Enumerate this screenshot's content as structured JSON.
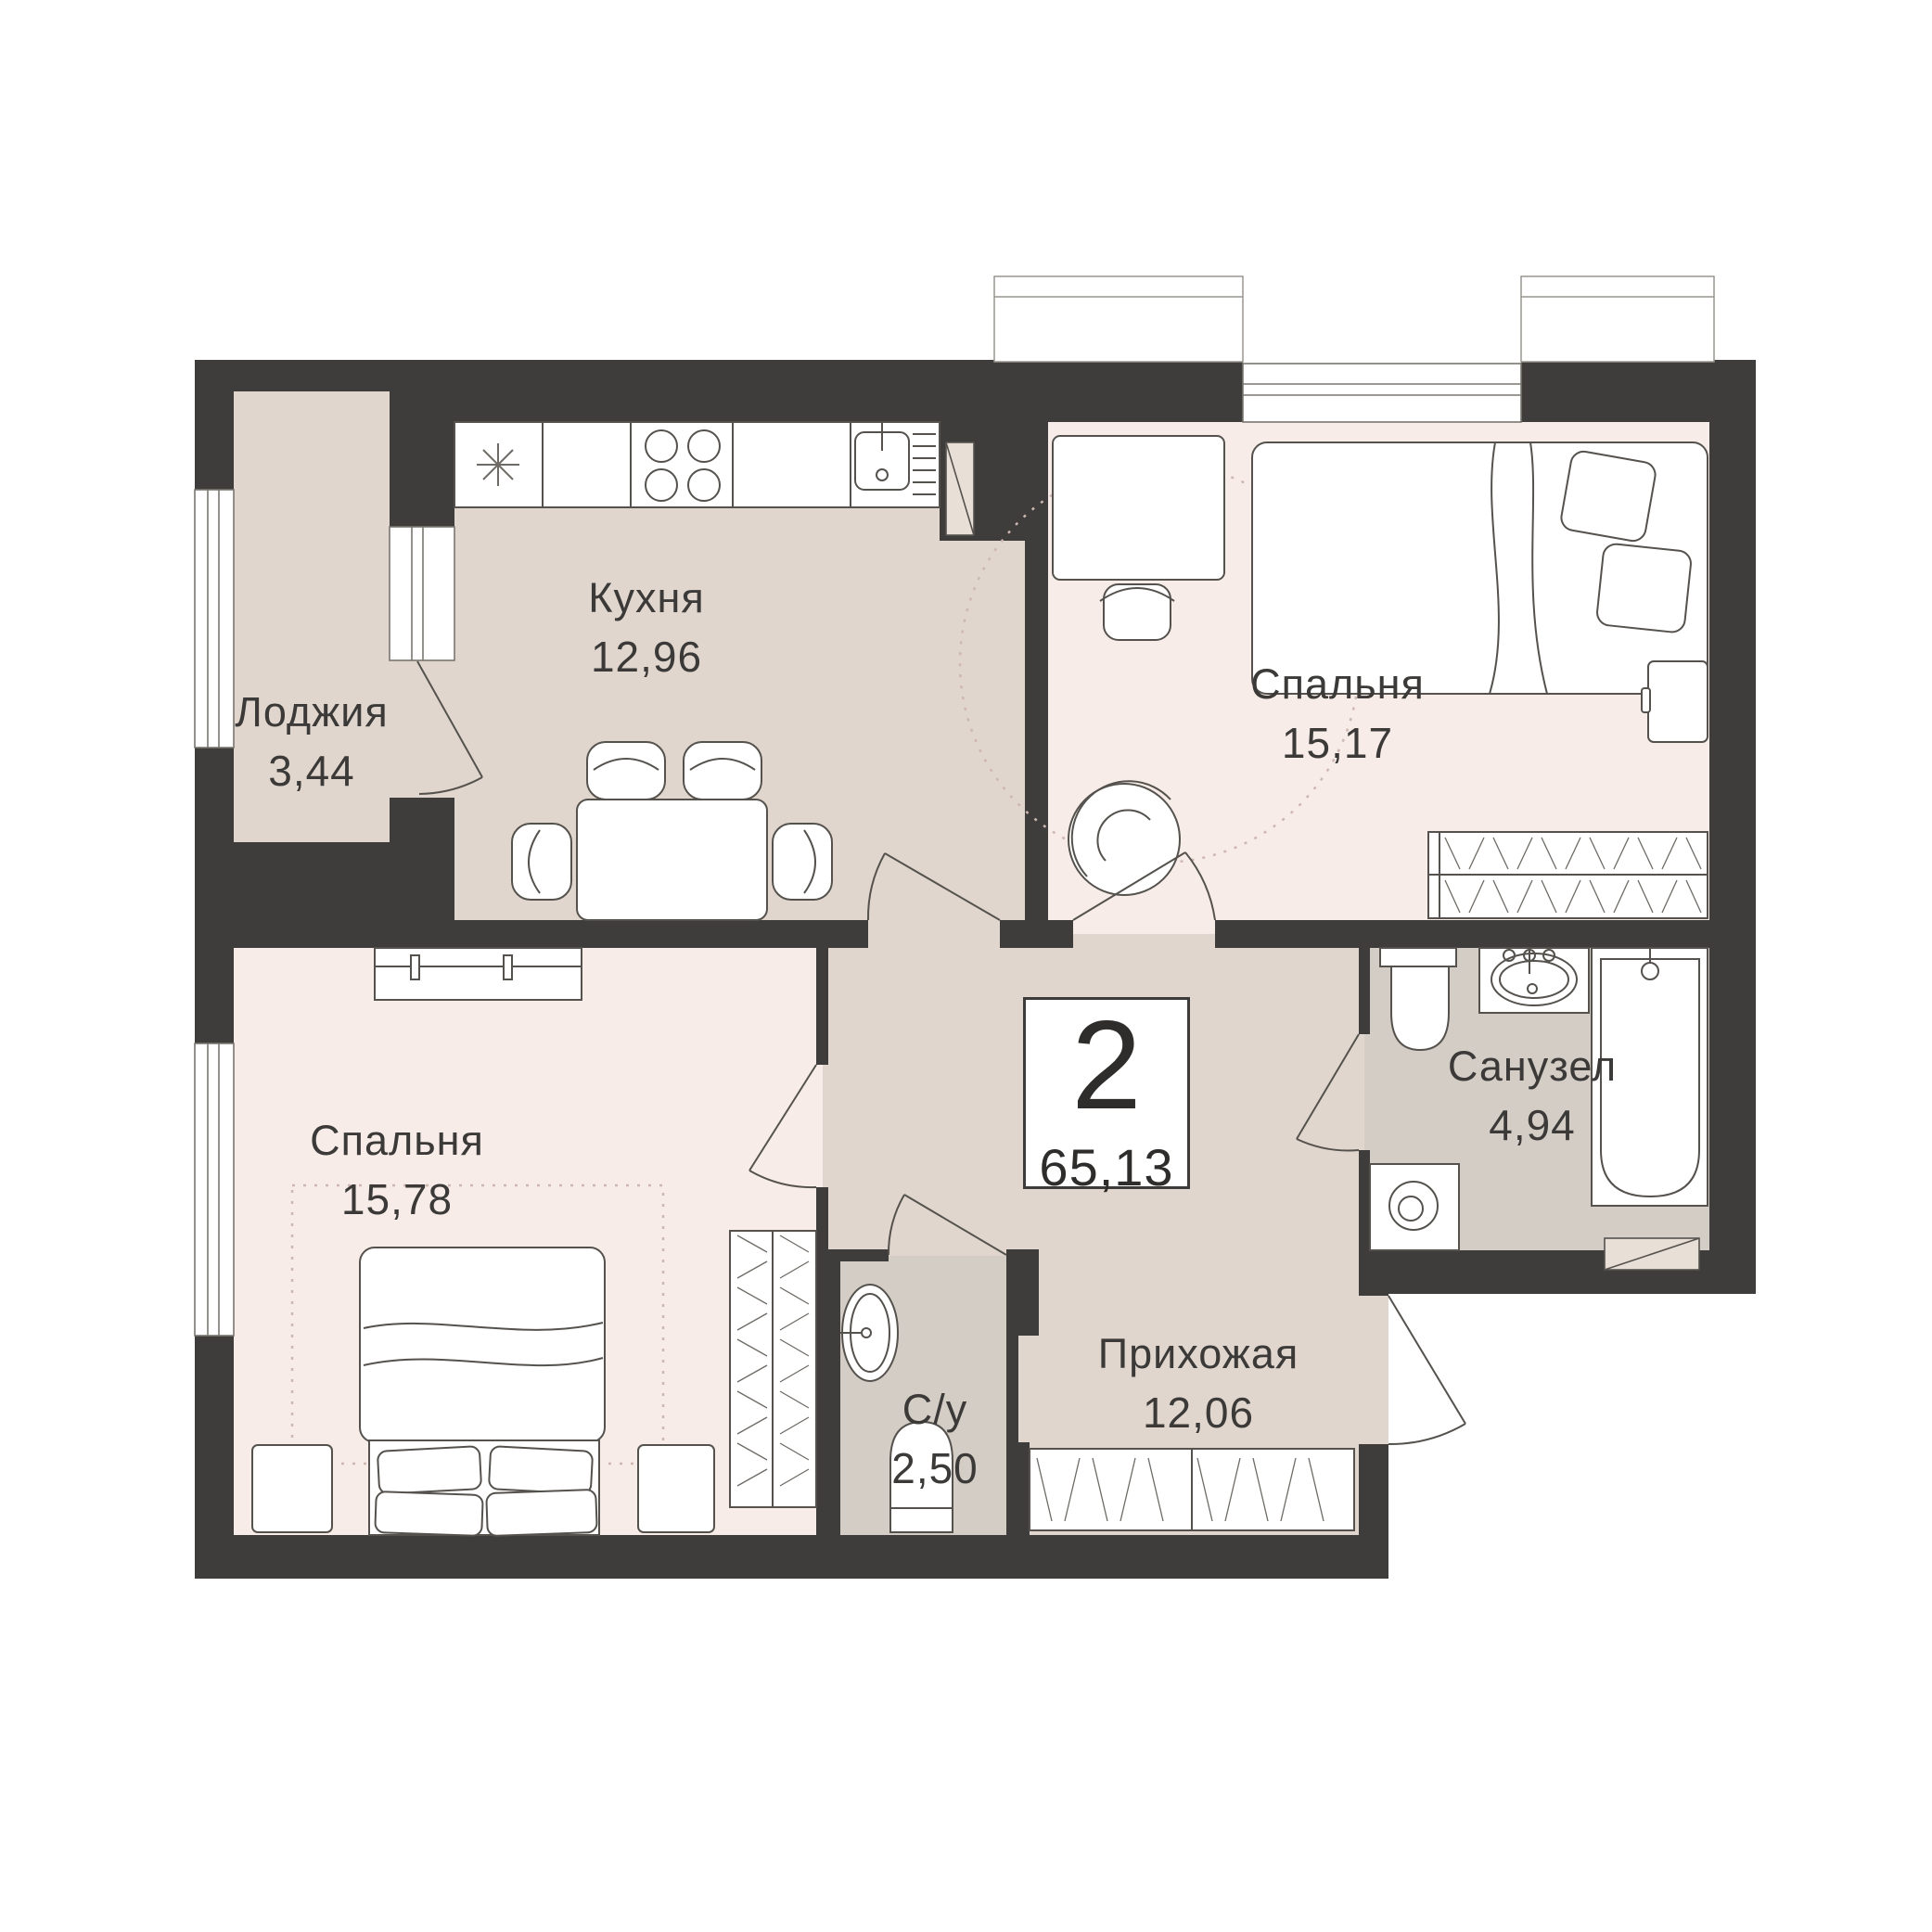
{
  "plan": {
    "type": "apartment-floor-plan",
    "badge": {
      "rooms_count": "2",
      "total_area": "65,13"
    },
    "rooms": [
      {
        "key": "kitchen",
        "name": "Кухня",
        "area": "12,96"
      },
      {
        "key": "loggia",
        "name": "Лоджия",
        "area": "3,44"
      },
      {
        "key": "bedroom_top",
        "name": "Спальня",
        "area": "15,17"
      },
      {
        "key": "bedroom_bottom",
        "name": "Спальня",
        "area": "15,78"
      },
      {
        "key": "bathroom",
        "name": "Санузел",
        "area": "4,94"
      },
      {
        "key": "wc",
        "name": "С/у",
        "area": "2,50"
      },
      {
        "key": "hallway",
        "name": "Прихожая",
        "area": "12,06"
      }
    ],
    "colors": {
      "wall": "#3e3d3b",
      "floor_warm": "#e0d6cd",
      "floor_bedroom": "#f7ece8",
      "floor_wet": "#d4cdc5",
      "furniture_outline": "#55524e"
    }
  }
}
